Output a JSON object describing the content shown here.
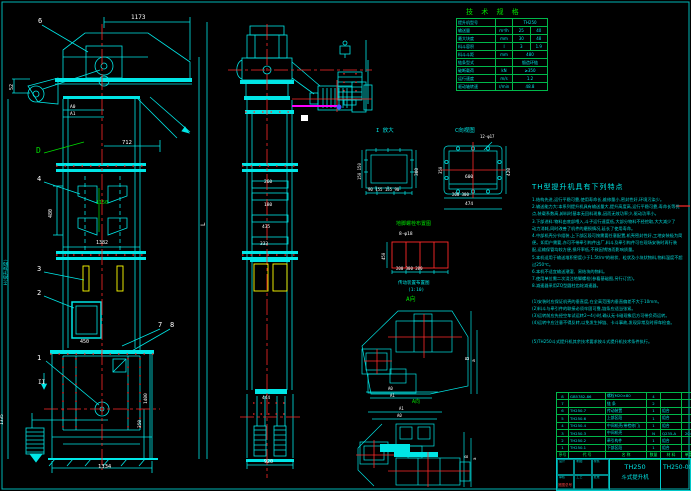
{
  "colors": {
    "bg": "#000000",
    "line": "#00e6e6",
    "grid": "#00b84a",
    "center": "#ff2a2a",
    "bucket": "#ffff00",
    "highlight": "#ff00ff",
    "text": "#00e6e6"
  },
  "labels": [
    "1173",
    "6",
    "52",
    "A0",
    "A1",
    "712",
    "D",
    "4",
    "480",
    "1150",
    "1382",
    "3",
    "2",
    "7",
    "8",
    "450",
    "1",
    "II",
    "1400",
    "350",
    "1335",
    "1334",
    "H(提升高度)",
    "L",
    "260",
    "180",
    "435",
    "333",
    "444",
    "920",
    "I 放大",
    "300",
    "150 150",
    "90 155 155 90",
    "C向视图",
    "12-φ17",
    "600",
    "420",
    "350",
    "200 300",
    "474",
    "地脚螺栓布置图",
    "8-φ18",
    "450",
    "200 300 200",
    "传动装置布置图",
    "(1:10)",
    "A向",
    "B",
    "a",
    "A0",
    "A1",
    "A1",
    "A0",
    "B",
    "a",
    "A向"
  ],
  "spec": {
    "title": "技 术 规 格",
    "rows": [
      [
        "提升机型号",
        "",
        "TH250"
      ],
      [
        "输送量",
        "m³/h",
        "25",
        "40"
      ],
      [
        "最大块度",
        "mm",
        "30",
        "48"
      ],
      [
        "料斗容积",
        "l",
        "3",
        "1.9"
      ],
      [
        "料斗斗距",
        "mm",
        "480"
      ],
      [
        "链条型式",
        "",
        "锻造环链"
      ],
      [
        "破断载荷",
        "kN",
        "≥350"
      ],
      [
        "运行速度",
        "m/s",
        "1.2"
      ],
      [
        "驱动轴转速",
        "r/min",
        "48.8"
      ]
    ]
  },
  "notes": {
    "title": "TH型提升机具有下列特点",
    "lines": [
      "1.结构先进,运行平稳可靠,使用寿命长,维修量小,密封性好,环境污染少。",
      "2.输送能力大:本系列提升机具有输送量大,提升高度高,运行平稳可靠,寿命长等优",
      "  点,装载系数高,卸料时基本无回料现象,因而无效功率少,驱动功率小。",
      "3.下部进料:物料由底部喂入,斗子运行速度低,大部分物料不经挖取,大大减少了",
      "  动力消耗,同时改善了机件的磨损情况,延长了使用寿命。",
      "4.中部机壳分节组装,上下部区段可按需要任意配置,机壳密封性好,工地安装极为简",
      "  便。如用户需要,亦可不带牵引构件出厂,料斗及牵引构件可在现场安装时再行装",
      "  配,运输保管均较方便,损坏率低,不致因锈蚀而影响质量。",
      "5.本机适用于输送堆积密度小于1.5t/m³的粉状、粒状及小块状物料,物料温度不超",
      "  过250℃。",
      "6.本机不适宜输送潮湿、易结块的物料。",
      "7.使用单位需二次浇注地脚螺栓(参看基础图,另行订货)。",
      "8.减速器采用ZQ型圆柱齿轮减速器。",
      "",
      "(1)安装时应保证机壳的垂直度,在全高范围内垂直偏差不大于10mm。",
      "(2)料斗与牵引件的联接必须牢固可靠,链条应适当张紧。",
      "(3)运转前应先经空车试运转2~4小时,确认无卡碰现象后方可带负荷运转。",
      "(4)运转中应注意不得反转,以免发生掉链、卡斗事故,发现异常及时停车检查。",
      "",
      "(5)TH250斗式提升机其余技术要求按斗式提升机技术条件执行。"
    ]
  },
  "parts": {
    "headers": [
      "序号",
      "代 号",
      "名 称",
      "数量",
      "材 料",
      "单重",
      "备注"
    ],
    "rows": [
      [
        "8",
        "GB5782-86",
        "螺栓M20×80",
        "4",
        "",
        "",
        ""
      ],
      [
        "7",
        "",
        "链 条",
        "2",
        "",
        "",
        ""
      ],
      [
        "6",
        "TH250.7",
        "传动装置",
        "1",
        "组合",
        "",
        ""
      ],
      [
        "5",
        "TH250.6",
        "上部区段",
        "1",
        "组合",
        "",
        "见图"
      ],
      [
        "4",
        "TH250.4",
        "中间机壳(带检修门)",
        "1",
        "组合",
        "",
        ""
      ],
      [
        "3",
        "TH250.3",
        "中间机壳",
        "N",
        "Q235-A",
        "204",
        ""
      ],
      [
        "2",
        "TH250.2",
        "牵引构件",
        "1",
        "组合",
        "",
        ""
      ],
      [
        "1",
        "TH250.1",
        "下部区段",
        "1",
        "组合",
        "",
        "见图"
      ]
    ]
  },
  "title_block": {
    "model": "TH250",
    "name": "斗式提升机",
    "dwg": "TH250-00",
    "cells": [
      "设计",
      "制图",
      "校核",
      "审核",
      "工艺",
      "批准"
    ],
    "note": "底图总号"
  }
}
